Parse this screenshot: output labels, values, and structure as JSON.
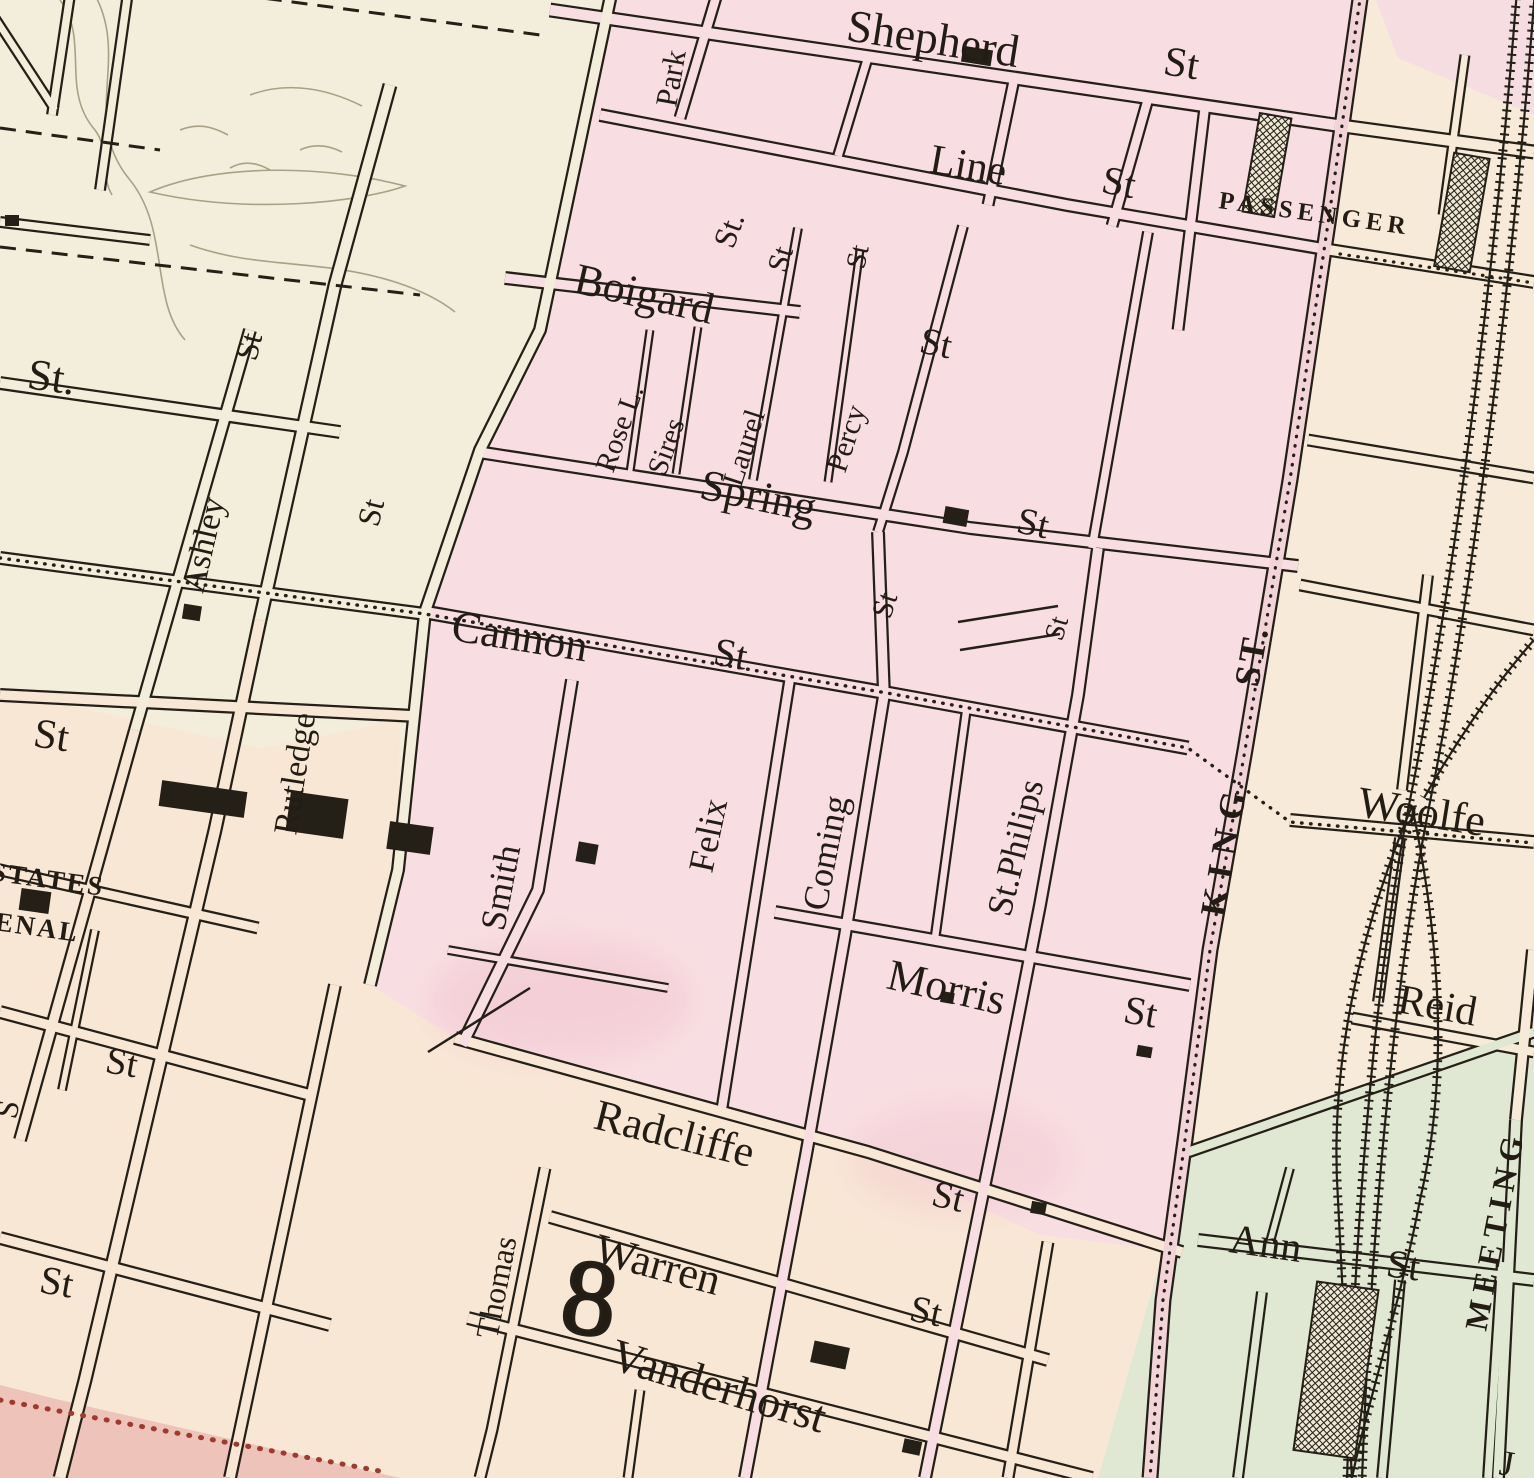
{
  "map": {
    "labels": {
      "shepherd": "Shepherd",
      "park": "Park",
      "line": "Line",
      "passenger": "PASSENGER",
      "boigard": "Boigard",
      "rose_lane": "Rose L.",
      "sires": "Sires",
      "laurel": "Laurel",
      "spring": "Spring",
      "percy": "Percy",
      "ashley": "Ashley",
      "rutledge": "Rutledge",
      "cannon": "Cannon",
      "smith": "Smith",
      "felix": "Felix",
      "coming": "Coming",
      "st_philips": "St.Philips",
      "king": "KING",
      "king_st": "ST.",
      "woolfe": "Woolfe",
      "reid": "Reid",
      "meeting": "MEETING",
      "morris": "Morris",
      "radcliffe": "Radcliffe",
      "warren": "Warren",
      "thomas": "Thomas",
      "vanderhorst": "Vanderhorst",
      "ann": "Ann",
      "states": "STATES",
      "arsenal": "ENAL",
      "ward_number": "8",
      "st": "St",
      "st_dot": "St.",
      "partial_left": "S",
      "partial_j": "J"
    },
    "palette": {
      "cream": "#f3eedb",
      "pink_ward": "#f8dee2",
      "peach": "#f9e7d6",
      "right_cream": "#f7ead8",
      "green_ward": "#e0e8d4",
      "king_street_road": "#f2d3d8",
      "boundary_band": "#eec3ba",
      "ink": "#241f17",
      "marsh": "#a9a085",
      "red_dots": "#a03a2f"
    }
  }
}
